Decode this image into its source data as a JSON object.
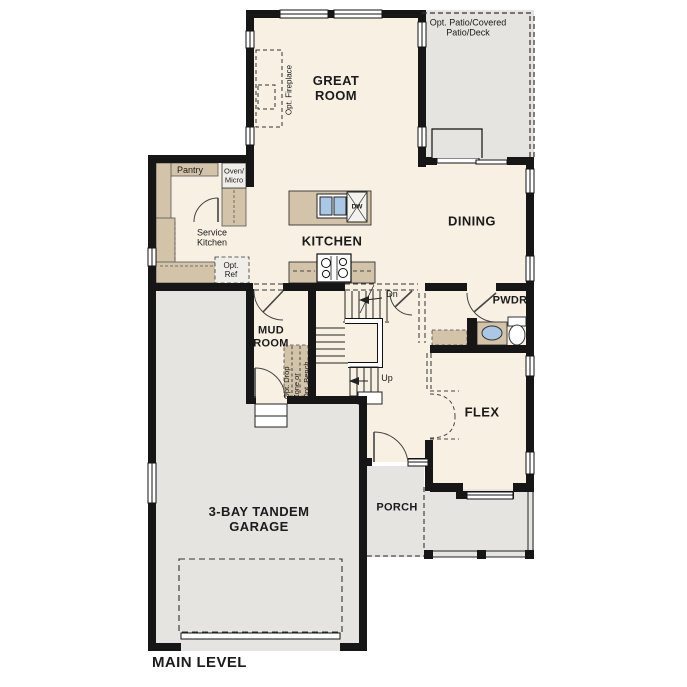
{
  "title": "MAIN LEVEL",
  "rooms": {
    "great_room": "GREAT ROOM",
    "patio": "Opt. Patio/Covered Patio/Deck",
    "dining": "DINING",
    "kitchen": "KITCHEN",
    "pantry": "Pantry",
    "service_kitchen": "Service Kitchen",
    "mud_room": "MUD ROOM",
    "pwdr": "PWDR",
    "flex": "FLEX",
    "porch": "PORCH",
    "garage": "3-BAY TANDEM GARAGE"
  },
  "annotations": {
    "opt_fireplace": "Opt. Fireplace",
    "oven_micro_line1": "Oven/",
    "oven_micro_line2": "Micro",
    "opt_ref": "Opt. Ref",
    "drop_zone_lines": [
      "Opt. Drop",
      "Zone or",
      "Opt. Bench"
    ],
    "stairs_down": "Dn",
    "stairs_up": "Up",
    "dishwasher": "DW"
  },
  "colors": {
    "floor_interior": "#F8F1E3",
    "floor_outdoor": "#E5E4E0",
    "cabinet_tan": "#D3C4A9",
    "wall_black": "#161616",
    "sink_blue": "#AAC7E6",
    "appliance_gray": "#EFEEE8"
  }
}
